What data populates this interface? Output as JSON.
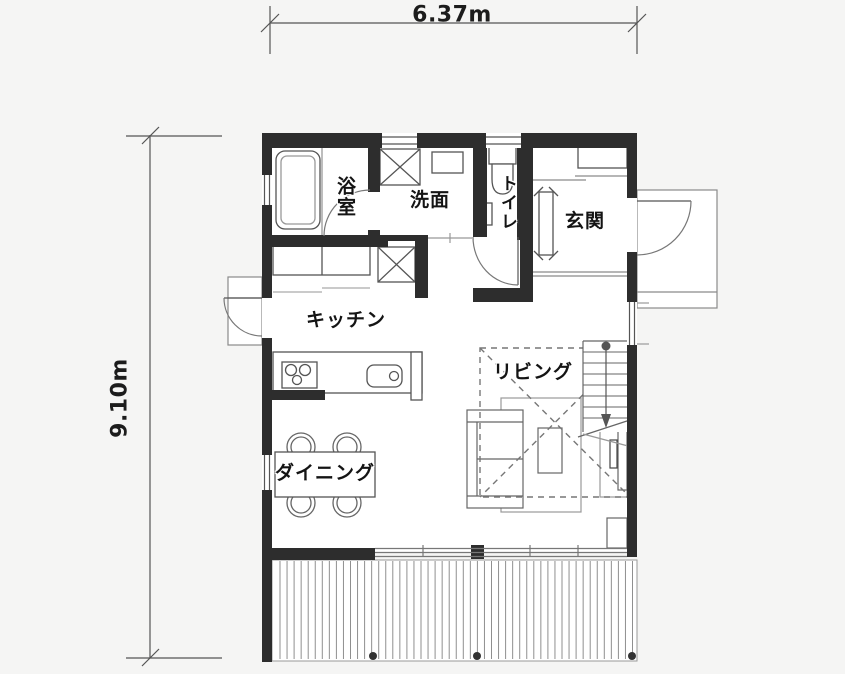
{
  "dimensions": {
    "width": "6.37m",
    "height": "9.10m"
  },
  "rooms": {
    "bathroom": "浴室",
    "washroom": "洗面",
    "toilet": "トイレ",
    "entrance": "玄関",
    "kitchen": "キッチン",
    "living": "リビング",
    "dining": "ダイニング"
  },
  "colors": {
    "wall": "#2d2d2d",
    "background": "#f5f5f4",
    "floor": "#ffffff",
    "line_dark": "#444444",
    "line_mid": "#777777",
    "line_light": "#999999"
  },
  "fixtures": [
    "bathtub",
    "washing-machine",
    "washbasin",
    "toilet-bowl",
    "refrigerator",
    "back-counter",
    "kitchen-island",
    "stove",
    "kitchen-sink",
    "dining-table",
    "dining-chair",
    "sofa",
    "rug",
    "coffee-table",
    "tv-board",
    "stairs",
    "down-arrow",
    "void-dashed-box",
    "shoe-cabinet",
    "entrance-handrail",
    "entrance-step",
    "front-door",
    "back-door",
    "bathroom-door",
    "toilet-door",
    "sliding-window",
    "wood-deck",
    "deck-post",
    "entrance-porch",
    "back-porch"
  ]
}
